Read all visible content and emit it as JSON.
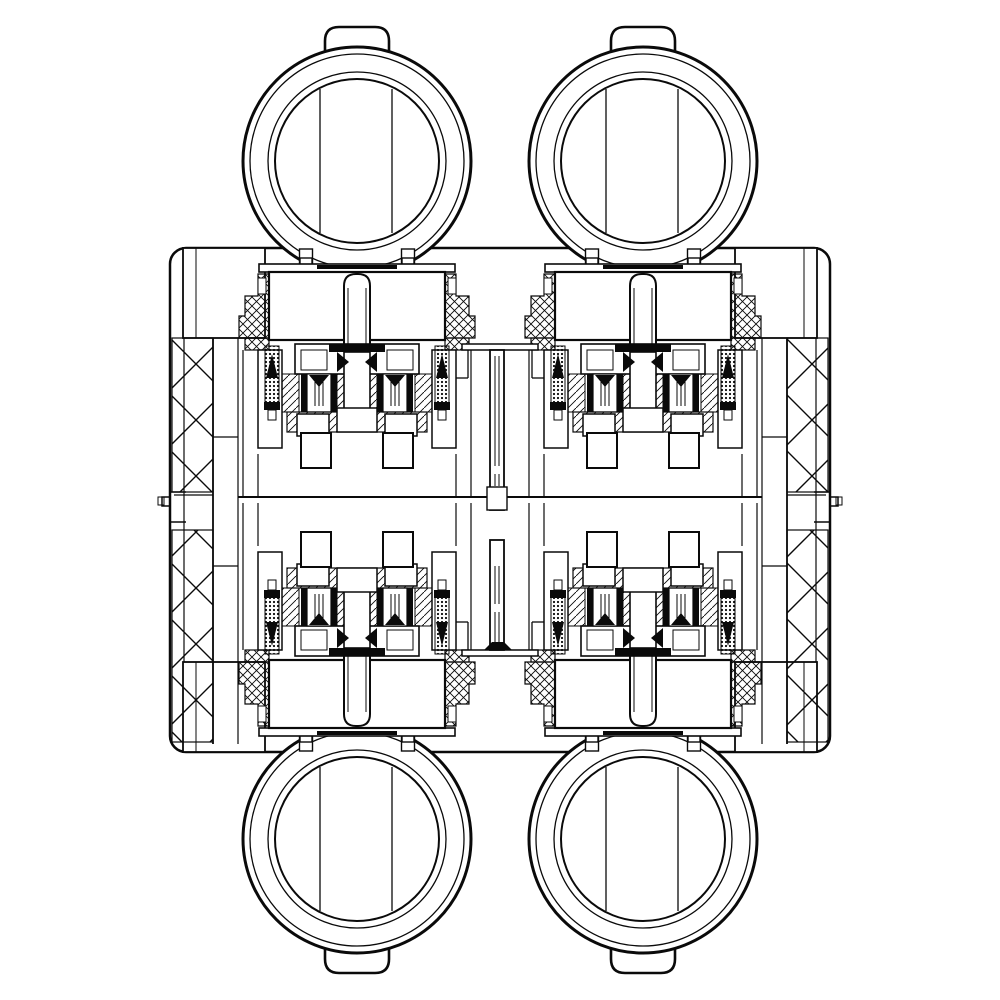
{
  "drawing": {
    "canvas": {
      "width": 1000,
      "height": 1000,
      "background": "#ffffff",
      "ink": "#0a0a0a"
    },
    "body": {
      "x": 170,
      "y": 248,
      "w": 660,
      "h": 504,
      "rx": 16,
      "sw": 2.5
    },
    "knob_geometry": {
      "r_outer": 114,
      "r_ring1": 107,
      "r_ring2": 89,
      "r_ring3": 82,
      "sw_outer": 3,
      "sw_ring": 1.3,
      "sw_ring3": 2,
      "band_dx": [
        -37,
        35
      ],
      "band_half": 72,
      "leg_dx": 51,
      "leg_w": 13,
      "leg_o1": 88,
      "leg_len": 18,
      "tab_hw": 32,
      "tab_o1": 100,
      "tab_o2": 134,
      "tab_r": 14,
      "tab_sw": 2.6
    },
    "knobs": [
      {
        "id": "knob-top-left",
        "cx": 357,
        "cy": 161,
        "tab": "up"
      },
      {
        "id": "knob-top-right",
        "cx": 643,
        "cy": 161,
        "tab": "up"
      },
      {
        "id": "knob-bottom-left",
        "cx": 357,
        "cy": 839,
        "tab": "down"
      },
      {
        "id": "knob-bottom-right",
        "cx": 643,
        "cy": 839,
        "tab": "down"
      }
    ],
    "pin": {
      "hw": 13,
      "o1": 26,
      "o2": 104,
      "r": 12,
      "inner_dx": 9,
      "io1": 40,
      "io2": 102,
      "sw": 2
    },
    "valve_template": [
      {
        "t": "rect",
        "dx": -57,
        "off": 10,
        "w": 12,
        "h": 7,
        "f": "w",
        "sw": 1.4,
        "m": true
      },
      {
        "t": "rect",
        "dx": -98,
        "off": 16,
        "w": 196,
        "h": 8,
        "f": "w",
        "sw": 1.6
      },
      {
        "t": "rect",
        "dx": -40,
        "off": 17,
        "w": 80,
        "h": 4,
        "f": "b"
      },
      {
        "t": "rect",
        "dx": -88,
        "off": 24,
        "w": 176,
        "h": 68,
        "f": "w",
        "sw": 2.2
      },
      {
        "t": "poly",
        "pts": [
          [
            -88,
            26
          ],
          [
            -99,
            26
          ],
          [
            -99,
            48
          ],
          [
            -112,
            48
          ],
          [
            -112,
            68
          ],
          [
            -118,
            68
          ],
          [
            -118,
            90
          ],
          [
            -88,
            90
          ]
        ],
        "f": "x",
        "sw": 1.2,
        "m": true
      },
      {
        "t": "rect",
        "dx": -99,
        "off": 30,
        "w": 8,
        "h": 16,
        "f": "w",
        "sw": 1,
        "m": true
      },
      {
        "t": "rect",
        "dx": -112,
        "off": 90,
        "w": 24,
        "h": 12,
        "f": "x",
        "sw": 1.2,
        "m": true
      },
      {
        "t": "pin"
      },
      {
        "t": "rect",
        "dx": -99,
        "off": 102,
        "w": 24,
        "h": 98,
        "f": "w",
        "sw": 1.5,
        "m": true
      },
      {
        "t": "rect",
        "dx": -92,
        "off": 98,
        "w": 14,
        "h": 58,
        "f": "d",
        "sw": 1,
        "m": true
      },
      {
        "t": "tri",
        "pts": [
          [
            -91,
            130
          ],
          [
            -79,
            130
          ],
          [
            -85,
            106
          ]
        ],
        "m": true
      },
      {
        "t": "rect",
        "dx": -93,
        "off": 154,
        "w": 16,
        "h": 8,
        "f": "b",
        "m": true
      },
      {
        "t": "rect",
        "dx": -89,
        "off": 162,
        "w": 8,
        "h": 10,
        "f": "w",
        "sw": 1,
        "m": true
      },
      {
        "t": "rect",
        "dx": -62,
        "off": 96,
        "w": 124,
        "h": 30,
        "f": "w",
        "sw": 1.6
      },
      {
        "t": "rect",
        "dx": -28,
        "off": 96,
        "w": 56,
        "h": 8,
        "f": "b"
      },
      {
        "t": "rect",
        "dx": -56,
        "off": 102,
        "w": 26,
        "h": 20,
        "f": "w",
        "sw": 1,
        "m": true
      },
      {
        "t": "rect",
        "dx": -13,
        "off": 104,
        "w": 26,
        "h": 64,
        "f": "w",
        "sw": 1.6
      },
      {
        "t": "tri",
        "pts": [
          [
            -20,
            104
          ],
          [
            -8,
            114
          ],
          [
            -20,
            124
          ]
        ],
        "m": true
      },
      {
        "t": "rect",
        "dx": -56,
        "off": 126,
        "w": 6,
        "h": 38,
        "f": "b",
        "m": true
      },
      {
        "t": "rect",
        "dx": -26,
        "off": 126,
        "w": 6,
        "h": 38,
        "f": "b",
        "m": true
      },
      {
        "t": "rect",
        "dx": -50,
        "off": 126,
        "w": 24,
        "h": 38,
        "f": "w",
        "sw": 1.2,
        "m": true
      },
      {
        "t": "vline",
        "dx": -42,
        "o1": 134,
        "o2": 158,
        "sw": 1,
        "m": true
      },
      {
        "t": "vline",
        "dx": -38,
        "o1": 134,
        "o2": 158,
        "sw": 1,
        "m": true
      },
      {
        "t": "vline",
        "dx": -34,
        "o1": 134,
        "o2": 158,
        "sw": 1,
        "m": true
      },
      {
        "t": "tri",
        "pts": [
          [
            -48,
            127
          ],
          [
            -28,
            127
          ],
          [
            -38,
            139
          ]
        ],
        "m": true
      },
      {
        "t": "rect",
        "dx": -75,
        "off": 126,
        "w": 17,
        "h": 38,
        "f": "g",
        "sw": 1,
        "m": true
      },
      {
        "t": "rect",
        "dx": -20,
        "off": 126,
        "w": 7,
        "h": 38,
        "f": "g",
        "sw": 1,
        "m": true
      },
      {
        "t": "rect",
        "dx": -70,
        "off": 164,
        "w": 140,
        "h": 20,
        "f": "g",
        "sw": 1.2
      },
      {
        "t": "rect",
        "dx": -20,
        "off": 160,
        "w": 40,
        "h": 24,
        "f": "w",
        "sw": 1.5
      },
      {
        "t": "rect",
        "dx": -60,
        "off": 166,
        "w": 32,
        "h": 22,
        "f": "w",
        "sw": 1.5,
        "m": true
      },
      {
        "t": "rect",
        "dx": -56,
        "off": 185,
        "w": 30,
        "h": 35,
        "f": "w",
        "sw": 2,
        "m": true
      },
      {
        "t": "vline",
        "dx": -114,
        "o1": 102,
        "o2": 249,
        "sw": 1.2,
        "m": true
      },
      {
        "t": "vline",
        "dx": -99,
        "o1": 206,
        "o2": 249,
        "sw": 1.2,
        "m": true
      }
    ],
    "valves": [
      {
        "id": "valve-top-left",
        "cx": 357,
        "edge": 248,
        "dir": 1
      },
      {
        "id": "valve-top-right",
        "cx": 643,
        "edge": 248,
        "dir": 1
      },
      {
        "id": "valve-bottom-left",
        "cx": 357,
        "edge": 752,
        "dir": -1
      },
      {
        "id": "valve-bottom-right",
        "cx": 643,
        "edge": 752,
        "dir": -1
      }
    ],
    "interior": {
      "inner_end_lines": [
        [
          184,
          262,
          738,
          1.2
        ],
        [
          816,
          262,
          738,
          1.2
        ]
      ],
      "corner_blocks": [
        {
          "x": 183,
          "y": 248,
          "w": 82,
          "h": 90,
          "vx": 196
        },
        {
          "x": 735,
          "y": 248,
          "w": 82,
          "h": 90,
          "vx": 804
        },
        {
          "x": 183,
          "y": 662,
          "w": 82,
          "h": 90,
          "vx": 196
        },
        {
          "x": 735,
          "y": 662,
          "w": 82,
          "h": 90,
          "vx": 804
        }
      ],
      "hatch_columns": [
        {
          "x": 172,
          "y": 338,
          "w": 41,
          "h": 154
        },
        {
          "x": 172,
          "y": 530,
          "w": 41,
          "h": 212
        },
        {
          "x": 787,
          "y": 338,
          "w": 41,
          "h": 154
        },
        {
          "x": 787,
          "y": 530,
          "w": 41,
          "h": 212
        }
      ],
      "walls": [
        [
          213,
          338,
          744,
          1.8
        ],
        [
          238,
          338,
          744,
          1.2
        ],
        [
          787,
          338,
          744,
          1.8
        ],
        [
          762,
          338,
          744,
          1.2
        ]
      ],
      "wall_joints": [
        [
          213,
          238,
          437
        ],
        [
          213,
          238,
          566
        ],
        [
          762,
          787,
          437
        ],
        [
          762,
          787,
          566
        ]
      ],
      "midline": {
        "x1": 238,
        "x2": 762,
        "y": 497,
        "sw": 2
      },
      "clip_lines": [
        [
          174,
          213,
          495,
          1.2
        ],
        [
          787,
          826,
          495,
          1.2
        ]
      ],
      "clips": {
        "paths": [
          "M 186 492 l -16 0 l 0 5 l -8 0 l 0 9 l 8 0 l 0 16 l 16 0",
          "M 814 492 l 16 0 l 0 5 l 8 0 l 0 9 l -8 0 l 0 16 l -16 0"
        ],
        "curls": [
          [
            158,
            497,
            6,
            8
          ],
          [
            836,
            497,
            6,
            8
          ]
        ],
        "sw": 1.5
      },
      "stems": {
        "top": {
          "shelf": [
            462,
            344,
            76,
            6
          ],
          "fillets": [
            [
              468,
              350,
              378
            ],
            [
              532,
              350,
              378
            ]
          ],
          "ticks": [
            [
              456,
              468,
              378
            ],
            [
              532,
              544,
              378
            ]
          ],
          "tube": [
            490,
            350,
            14,
            160
          ],
          "base": [
            487,
            487,
            20,
            23
          ],
          "inner": [
            [
              495,
              356,
              466
            ],
            [
              499,
              356,
              466
            ],
            [
              495,
              474,
              486
            ],
            [
              499,
              474,
              486
            ]
          ]
        },
        "bottom": {
          "shelf": [
            462,
            650,
            76,
            6
          ],
          "fillets": [
            [
              468,
              622,
              650
            ],
            [
              532,
              622,
              650
            ]
          ],
          "ticks": [
            [
              456,
              468,
              622
            ],
            [
              532,
              544,
              622
            ]
          ],
          "tube": [
            490,
            540,
            14,
            110
          ],
          "inner": [
            [
              495,
              566,
              604
            ],
            [
              499,
              566,
              604
            ],
            [
              495,
              612,
              644
            ],
            [
              499,
              612,
              644
            ]
          ],
          "trumpet": [
            [
              484,
              650
            ],
            [
              512,
              650
            ],
            [
              504,
              642
            ],
            [
              492,
              642
            ]
          ]
        }
      }
    }
  }
}
